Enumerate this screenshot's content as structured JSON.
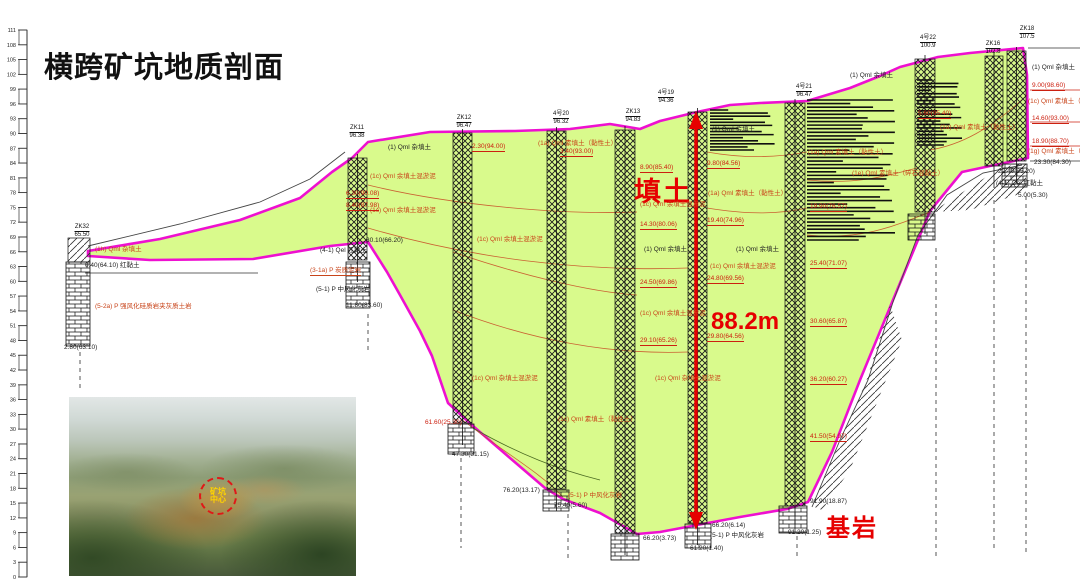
{
  "title": "横跨矿坑地质剖面",
  "colors": {
    "fill_green": "#d9fa8c",
    "outline_magenta": "#ee10d0",
    "annotation_red": "#e60000",
    "strata_label_red": "#c8441a",
    "depth_mark_red": "#cc2010",
    "text_black": "#222222"
  },
  "annotations": {
    "fill_soil": "填土",
    "depth": "88.2m",
    "bedrock": "基岩"
  },
  "ruler": {
    "values": [
      111,
      108,
      105,
      102,
      99,
      96,
      93,
      90,
      87,
      84,
      81,
      78,
      75,
      72,
      69,
      66,
      63,
      60,
      57,
      54,
      51,
      48,
      45,
      42,
      39,
      36,
      33,
      30,
      27,
      24,
      21,
      18,
      15,
      12,
      9,
      6,
      3,
      0
    ]
  },
  "photo": {
    "circle_label_line1": "矿坑",
    "circle_label_line2": "中心"
  },
  "boreholes": [
    {
      "x": 82,
      "y": 224,
      "name": "ZK32",
      "elevation": "65.50"
    },
    {
      "x": 357,
      "y": 125,
      "name": "ZK11",
      "elevation": "96.38"
    },
    {
      "x": 464,
      "y": 115,
      "name": "ZK12",
      "elevation": "96.47"
    },
    {
      "x": 561,
      "y": 111,
      "name": "4号20",
      "elevation": "96.32"
    },
    {
      "x": 633,
      "y": 109,
      "name": "ZK13",
      "elevation": "94.83"
    },
    {
      "x": 666,
      "y": 90,
      "name": "4号19",
      "elevation": "94.36"
    },
    {
      "x": 804,
      "y": 84,
      "name": "4号21",
      "elevation": "96.47"
    },
    {
      "x": 928,
      "y": 35,
      "name": "4号22",
      "elevation": "100.9"
    },
    {
      "x": 993,
      "y": 41,
      "name": "ZK16",
      "elevation": "102.8"
    },
    {
      "x": 1027,
      "y": 26,
      "name": "ZK18",
      "elevation": "107.5"
    }
  ],
  "strata_labels": [
    {
      "x": 388,
      "y": 146,
      "t": "(1) Qml 杂填土",
      "c": "k"
    },
    {
      "x": 712,
      "y": 128,
      "t": "(1) Qml 余填土",
      "c": "k"
    },
    {
      "x": 850,
      "y": 74,
      "t": "(1) Qml 余填土",
      "c": "k"
    },
    {
      "x": 1032,
      "y": 66,
      "t": "(1) Qml 杂填土",
      "c": "k"
    },
    {
      "x": 644,
      "y": 248,
      "t": "(1) Qml 余填土",
      "c": "k"
    },
    {
      "x": 736,
      "y": 248,
      "t": "(1) Qml 余填土",
      "c": "k"
    },
    {
      "x": 370,
      "y": 175,
      "t": "(1c) Qml 余填土混淤泥",
      "c": "r"
    },
    {
      "x": 370,
      "y": 209,
      "t": "(1c) Qml 余填土混淤泥",
      "c": "r"
    },
    {
      "x": 477,
      "y": 238,
      "t": "(1c) Qml 余填土混淤泥",
      "c": "r"
    },
    {
      "x": 640,
      "y": 203,
      "t": "(1c) Qml 余填土混淤泥",
      "c": "r"
    },
    {
      "x": 710,
      "y": 265,
      "t": "(1c) Qml 余填土混淤泥",
      "c": "r"
    },
    {
      "x": 640,
      "y": 312,
      "t": "(1c) Qml 余填土混淤泥",
      "c": "r"
    },
    {
      "x": 558,
      "y": 418,
      "t": "(1c) Qml 素填土（黏性土）",
      "c": "r"
    },
    {
      "x": 472,
      "y": 377,
      "t": "(1c) Qml 杂填土混淤泥",
      "c": "r"
    },
    {
      "x": 655,
      "y": 377,
      "t": "(1c) Qml 杂填土混淤泥",
      "c": "r"
    },
    {
      "x": 538,
      "y": 142,
      "t": "(1a) Qml 素填土（黏性土）",
      "c": "r"
    },
    {
      "x": 708,
      "y": 192,
      "t": "(1a) Qml 素填土（黏性土）",
      "c": "r"
    },
    {
      "x": 808,
      "y": 151,
      "t": "(1a) Qml 素填土（黏性土）",
      "c": "r"
    },
    {
      "x": 940,
      "y": 126,
      "t": "(1a) Qml 素填土（黏性土）",
      "c": "r"
    },
    {
      "x": 852,
      "y": 172,
      "t": "(1e) Qml 素填土（碎石混黏土）",
      "c": "r"
    },
    {
      "x": 95,
      "y": 248,
      "t": "(1h) Qml 杂填土",
      "c": "r"
    },
    {
      "x": 85,
      "y": 264,
      "t": "0.40(64.10)  红黏土",
      "c": "k"
    },
    {
      "x": 95,
      "y": 305,
      "t": "(5-2a) P 强风化硅质岩夹灰质土岩",
      "c": "r"
    },
    {
      "x": 64,
      "y": 346,
      "t": "2.80(63.10)",
      "c": "k"
    },
    {
      "x": 366,
      "y": 239,
      "t": "30.10(66.20)",
      "c": "k"
    },
    {
      "x": 320,
      "y": 249,
      "t": "(4-1) Qel 红黏土",
      "c": "k"
    },
    {
      "x": 310,
      "y": 269,
      "t": "(3-1a) P 炭质泥岩",
      "c": "r",
      "u": 1
    },
    {
      "x": 316,
      "y": 288,
      "t": "(5-1) P 中风化灰岩",
      "c": "k"
    },
    {
      "x": 346,
      "y": 304,
      "t": "11.80(83.60)",
      "c": "k"
    },
    {
      "x": 425,
      "y": 421,
      "t": "61.60(25.30)",
      "c": "R"
    },
    {
      "x": 452,
      "y": 453,
      "t": "47.30(31.15)",
      "c": "k"
    },
    {
      "x": 503,
      "y": 489,
      "t": "76.20(13.17)",
      "c": "k"
    },
    {
      "x": 568,
      "y": 494,
      "t": "(5-1) P 中风化灰岩",
      "c": "r"
    },
    {
      "x": 554,
      "y": 504,
      "t": "75.40(5.60)",
      "c": "k"
    },
    {
      "x": 643,
      "y": 537,
      "t": "66.20(3.73)",
      "c": "k"
    },
    {
      "x": 712,
      "y": 524,
      "t": "66.20(6.14)",
      "c": "k"
    },
    {
      "x": 710,
      "y": 534,
      "t": "(5-1) P 中风化灰岩",
      "c": "k"
    },
    {
      "x": 690,
      "y": 547,
      "t": "61.20(1.40)",
      "c": "k"
    },
    {
      "x": 810,
      "y": 500,
      "t": "91.90(18.87)",
      "c": "k"
    },
    {
      "x": 788,
      "y": 531,
      "t": "91.20(1.25)",
      "c": "k"
    },
    {
      "x": 1032,
      "y": 84,
      "t": "9.00(98.60)",
      "c": "R",
      "u": 1
    },
    {
      "x": 1028,
      "y": 100,
      "t": "(1c) Qml 素填土（淤",
      "c": "r"
    },
    {
      "x": 1032,
      "y": 117,
      "t": "14.60(93.00)",
      "c": "R",
      "u": 1
    },
    {
      "x": 1032,
      "y": 140,
      "t": "18.90(88.70)",
      "c": "R",
      "u": 1
    },
    {
      "x": 1028,
      "y": 150,
      "t": "(1g) Qml 素填土（淤",
      "c": "r"
    },
    {
      "x": 1034,
      "y": 161,
      "t": "23.30(84.30)",
      "c": "k"
    },
    {
      "x": 998,
      "y": 170,
      "t": "22.40(85.20)",
      "c": "k"
    },
    {
      "x": 996,
      "y": 182,
      "t": "(4-1) Qel 红黏土",
      "c": "k"
    },
    {
      "x": 1018,
      "y": 194,
      "t": "5.00(5.30)",
      "c": "k"
    },
    {
      "x": 472,
      "y": 145,
      "t": "2.30(94.00)",
      "c": "R",
      "u": 1
    },
    {
      "x": 560,
      "y": 150,
      "t": "3.40(93.00)",
      "c": "R",
      "u": 1
    },
    {
      "x": 707,
      "y": 162,
      "t": "9.80(84.56)",
      "c": "R",
      "u": 1
    },
    {
      "x": 640,
      "y": 166,
      "t": "8.90(85.40)",
      "c": "R",
      "u": 1
    },
    {
      "x": 707,
      "y": 219,
      "t": "19.40(74.96)",
      "c": "R",
      "u": 1
    },
    {
      "x": 640,
      "y": 223,
      "t": "14.30(80.06)",
      "c": "R",
      "u": 1
    },
    {
      "x": 707,
      "y": 277,
      "t": "24.80(69.56)",
      "c": "R",
      "u": 1
    },
    {
      "x": 640,
      "y": 281,
      "t": "24.50(69.86)",
      "c": "R",
      "u": 1
    },
    {
      "x": 707,
      "y": 335,
      "t": "29.80(64.56)",
      "c": "R",
      "u": 1
    },
    {
      "x": 640,
      "y": 339,
      "t": "29.10(65.26)",
      "c": "R",
      "u": 1
    },
    {
      "x": 810,
      "y": 205,
      "t": "19.90(76.57)",
      "c": "R",
      "u": 1
    },
    {
      "x": 810,
      "y": 262,
      "t": "25.40(71.07)",
      "c": "R",
      "u": 1
    },
    {
      "x": 810,
      "y": 320,
      "t": "30.60(65.87)",
      "c": "R",
      "u": 1
    },
    {
      "x": 810,
      "y": 378,
      "t": "36.20(60.27)",
      "c": "R",
      "u": 1
    },
    {
      "x": 810,
      "y": 435,
      "t": "41.50(54.97)",
      "c": "R",
      "u": 1
    },
    {
      "x": 346,
      "y": 192,
      "t": "6.30(90.08)",
      "c": "R",
      "u": 1
    },
    {
      "x": 346,
      "y": 204,
      "t": "8.40(87.98)",
      "c": "R",
      "u": 1
    },
    {
      "x": 918,
      "y": 112,
      "t": "5.60(95.40)",
      "c": "R",
      "u": 1
    }
  ]
}
